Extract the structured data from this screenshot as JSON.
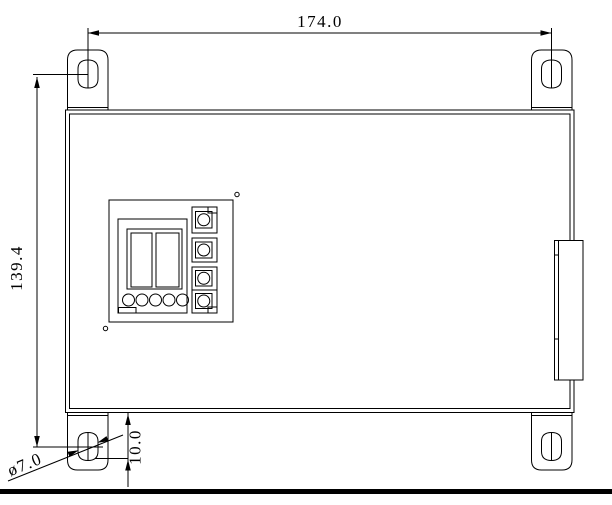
{
  "drawing": {
    "dimensions": {
      "width": "174.0",
      "height": "139.4",
      "bottom_hole_offset": "10.0",
      "hole_diameter": "ø7.0"
    },
    "colors": {
      "line": "#000000",
      "background": "#ffffff"
    }
  }
}
